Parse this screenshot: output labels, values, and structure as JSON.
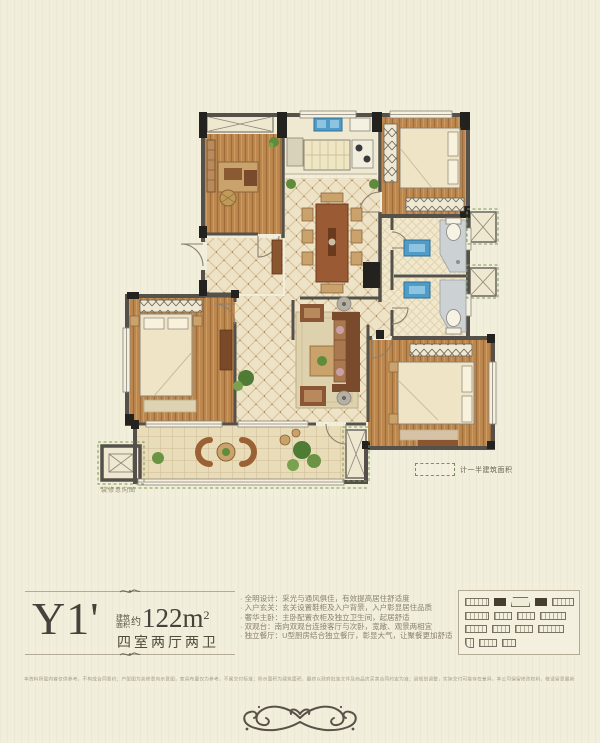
{
  "colors": {
    "wall": "#55504a",
    "wall_black": "#24221f",
    "wood": "#bc8850",
    "tile": "#eee3c6",
    "accent_blue": "#4f9cc8",
    "plant_green": "#5f8c3c",
    "title_text": "#46413a",
    "body_text": "#8a8270"
  },
  "plan": {
    "decor_note": "装修意向图",
    "legend_label": "计一半建筑面积"
  },
  "info": {
    "model": "Y1'",
    "area_label_top": "建筑",
    "area_label_bottom": "面积",
    "area_approx": "约",
    "area_value": "122m",
    "area_sup": "2",
    "layout": "四室两厅两卫",
    "features": [
      "全明设计：采光与通风俱佳，有效提高居住舒适度",
      "入户玄关：玄关设置鞋柜及入户背景，入户彰显居住品质",
      "奢华主卧：主卧配置衣柜及独立卫生间，起居舒适",
      "双观台：南向双观台连接客厅与次卧，宽敞、观景两相宜",
      "独立餐厅：U型厨房结合独立餐厅，彰显大气，让聚餐更加舒适"
    ]
  },
  "keymap": {
    "rows": [
      [
        {
          "w": 24
        },
        {
          "w": 12,
          "dark": true
        },
        {
          "w": 20,
          "fan": true
        },
        {
          "w": 12,
          "dark": true
        },
        {
          "w": 22
        }
      ],
      [
        {
          "w": 24
        },
        {
          "w": 18
        },
        {
          "w": 18
        },
        {
          "w": 26
        }
      ],
      [
        {
          "w": 22
        },
        {
          "w": 18
        },
        {
          "w": 18
        },
        {
          "w": 26
        }
      ],
      [
        {
          "w": 9,
          "small": true
        },
        {
          "w": 18
        },
        {
          "w": 14
        }
      ]
    ]
  },
  "disclaimer": "本资料所载内容仅供参考，不构成合同要约；户型图为装修意向示意图，家具布置仅为参考，不属交付标准；所示面积为建筑面积，最终以政府批准文件及商品房买卖合同约定为准；因规划调整，实际交付可能存在差异，本公司保留修改权利，敬请留意最新资料。"
}
